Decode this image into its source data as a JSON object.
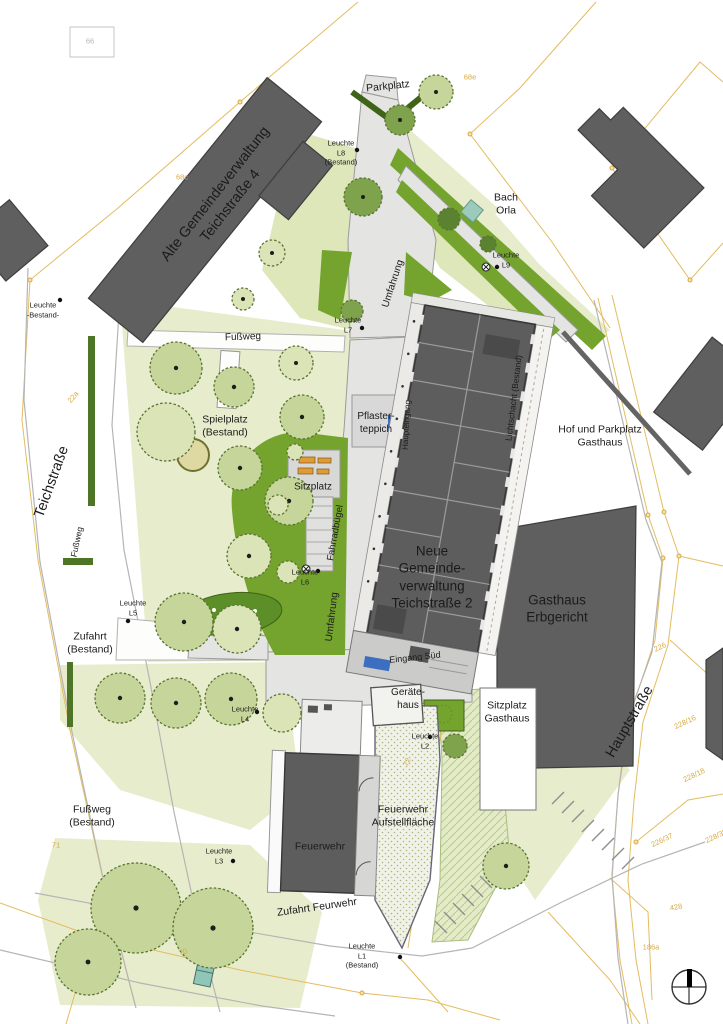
{
  "colors": {
    "label_black": "#1b1b1b",
    "parcel_orange": "#d8a940",
    "parcel_line": "#e3bc5f",
    "building_gray": "#5f5f5f",
    "road_gray": "#e4e4e2",
    "green_bright": "#74a42e",
    "green_pale": "#e7edcc",
    "hedge_dark": "#4e7426",
    "water_teal": "#93c7b7",
    "marker_blue": "#3c6fc1",
    "bench_orange": "#e39a35"
  },
  "compass": {
    "name": "north-arrow"
  },
  "map_labels": [
    {
      "name": "label-parkplatz",
      "text": "Parkplatz",
      "x": 388,
      "y": 87,
      "rot": -6,
      "size": 10.5
    },
    {
      "name": "label-leuchte-l8",
      "text": "Leuchte\nL8\n(Bestand)",
      "x": 341,
      "y": 153,
      "rot": 0,
      "size": 7.5
    },
    {
      "name": "label-alte-gemeindeverwaltung",
      "text": "Alte Gemeindeverwaltung\nTeichstraße 4",
      "x": 223,
      "y": 200,
      "rot": -52,
      "size": 14.5
    },
    {
      "name": "label-bach-orla",
      "text": "Bach\nOrla",
      "x": 506,
      "y": 205,
      "rot": 0,
      "size": 10.5
    },
    {
      "name": "label-leuchte-l9",
      "text": "Leuchte\nL9",
      "x": 506,
      "y": 260,
      "rot": 0,
      "size": 7.5
    },
    {
      "name": "label-leuchte-bestand",
      "text": "Leuchte\n-Bestand-",
      "x": 43,
      "y": 310,
      "rot": 0,
      "size": 7.5
    },
    {
      "name": "label-fussweg-nord",
      "text": "Fußweg",
      "x": 243,
      "y": 338,
      "rot": -2,
      "size": 10
    },
    {
      "name": "label-leuchte-l7",
      "text": "Leuchte\nL7",
      "x": 348,
      "y": 325,
      "rot": 0,
      "size": 7.5
    },
    {
      "name": "label-umfahrung-nord",
      "text": "Umfahrung",
      "x": 394,
      "y": 284,
      "rot": -72,
      "size": 10
    },
    {
      "name": "label-haupteingang",
      "text": "Haupteingang",
      "x": 407,
      "y": 425,
      "rot": -87,
      "size": 8
    },
    {
      "name": "label-lichtschacht",
      "text": "Lichtschacht (Bestand)",
      "x": 514,
      "y": 398,
      "rot": -83,
      "size": 8.5
    },
    {
      "name": "label-hof-parkplatz-gasthaus",
      "text": "Hof und Parkplatz\nGasthaus",
      "x": 600,
      "y": 437,
      "rot": 0,
      "size": 10.5
    },
    {
      "name": "label-spielplatz",
      "text": "Spielplatz\n(Bestand)",
      "x": 225,
      "y": 427,
      "rot": 0,
      "size": 10.5
    },
    {
      "name": "label-teichstrasse",
      "text": "Teichstraße",
      "x": 52,
      "y": 482,
      "rot": -70,
      "size": 14.5
    },
    {
      "name": "label-pflasterteppich",
      "text": "Pflaster-\nteppich",
      "x": 376,
      "y": 424,
      "rot": 0,
      "size": 10
    },
    {
      "name": "label-sitzplatz",
      "text": "Sitzplatz",
      "x": 313,
      "y": 488,
      "rot": 0,
      "size": 10
    },
    {
      "name": "label-fahrradbuegel",
      "text": "Fahrradbügel",
      "x": 336,
      "y": 533,
      "rot": -80,
      "size": 9.5
    },
    {
      "name": "label-leuchte-l6",
      "text": "Leuchte\nL6",
      "x": 305,
      "y": 577,
      "rot": 0,
      "size": 7.5
    },
    {
      "name": "label-fussweg-west",
      "text": "Fußweg",
      "x": 77,
      "y": 542,
      "rot": -78,
      "size": 8.5
    },
    {
      "name": "label-neue-gemeindeverwaltung",
      "text": "Neue\nGemeinde-\nverwaltung\nTeichstraße 2",
      "x": 432,
      "y": 577,
      "rot": 0,
      "size": 13.5
    },
    {
      "name": "label-gasthaus-erbgericht",
      "text": "Gasthaus\nErbgericht",
      "x": 557,
      "y": 609,
      "rot": 0,
      "size": 13.5
    },
    {
      "name": "label-eingang-sued",
      "text": "Eingang Süd",
      "x": 415,
      "y": 658,
      "rot": -6,
      "size": 9
    },
    {
      "name": "label-leuchte-l5",
      "text": "Leuchte\nL5",
      "x": 133,
      "y": 608,
      "rot": 0,
      "size": 7.5
    },
    {
      "name": "label-zufahrt-bestand",
      "text": "Zufahrt\n(Bestand)",
      "x": 90,
      "y": 644,
      "rot": 0,
      "size": 10.5
    },
    {
      "name": "label-umfahrung-sued",
      "text": "Umfahrung",
      "x": 333,
      "y": 617,
      "rot": -83,
      "size": 10
    },
    {
      "name": "label-hauptstrasse",
      "text": "Hauptstraße",
      "x": 630,
      "y": 722,
      "rot": -60,
      "size": 14.5
    },
    {
      "name": "label-geraetehaus",
      "text": "Geräte-\nhaus",
      "x": 408,
      "y": 700,
      "rot": 0,
      "size": 10
    },
    {
      "name": "label-sitzplatz-gasthaus",
      "text": "Sitzplatz\nGasthaus",
      "x": 507,
      "y": 713,
      "rot": 0,
      "size": 10.5
    },
    {
      "name": "label-leuchte-l2",
      "text": "Leuchte\nL2",
      "x": 425,
      "y": 741,
      "rot": 0,
      "size": 7.5
    },
    {
      "name": "label-leuchte-l4",
      "text": "Leuchte\nL4",
      "x": 245,
      "y": 714,
      "rot": 0,
      "size": 7.5
    },
    {
      "name": "label-fussweg-bestand",
      "text": "Fußweg\n(Bestand)",
      "x": 92,
      "y": 817,
      "rot": 0,
      "size": 10.5
    },
    {
      "name": "label-leuchte-l3",
      "text": "Leuchte\nL3",
      "x": 219,
      "y": 856,
      "rot": 0,
      "size": 7.5
    },
    {
      "name": "label-feuerwehr",
      "text": "Feuerwehr",
      "x": 320,
      "y": 847,
      "rot": 0,
      "size": 10.5
    },
    {
      "name": "label-aufstellflaeche",
      "text": "Feuerwehr\nAufstellfläche",
      "x": 403,
      "y": 817,
      "rot": 0,
      "size": 10.5
    },
    {
      "name": "label-zufahrt-feuerwehr",
      "text": "Zufahrt Feurwehr",
      "x": 317,
      "y": 908,
      "rot": -8,
      "size": 10.5
    },
    {
      "name": "label-leuchte-l1",
      "text": "Leuchte\nL1\n(Bestand)",
      "x": 362,
      "y": 956,
      "rot": 0,
      "size": 7.5
    }
  ],
  "parcel_labels": [
    {
      "name": "parcel-68e",
      "text": "68e",
      "x": 470,
      "y": 77,
      "rot": 0
    },
    {
      "name": "parcel-68c",
      "text": "68c",
      "x": 182,
      "y": 177,
      "rot": 0
    },
    {
      "name": "parcel-22a",
      "text": "22a",
      "x": 73,
      "y": 397,
      "rot": -50
    },
    {
      "name": "parcel-71",
      "text": "71",
      "x": 56,
      "y": 845,
      "rot": 0
    },
    {
      "name": "parcel-226",
      "text": "226",
      "x": 660,
      "y": 647,
      "rot": -25
    },
    {
      "name": "parcel-228-16",
      "text": "228/16",
      "x": 685,
      "y": 722,
      "rot": -25
    },
    {
      "name": "parcel-228-18",
      "text": "228/18",
      "x": 694,
      "y": 775,
      "rot": -25
    },
    {
      "name": "parcel-226-37",
      "text": "226/37",
      "x": 662,
      "y": 840,
      "rot": -25
    },
    {
      "name": "parcel-228-35",
      "text": "228/35",
      "x": 716,
      "y": 836,
      "rot": -25
    },
    {
      "name": "parcel-428",
      "text": "428",
      "x": 676,
      "y": 907,
      "rot": -10
    },
    {
      "name": "parcel-186a",
      "text": "186a",
      "x": 651,
      "y": 947,
      "rot": 0
    },
    {
      "name": "parcel-70",
      "text": "70",
      "x": 183,
      "y": 952,
      "rot": -20
    },
    {
      "name": "parcel-72",
      "text": "72",
      "x": 407,
      "y": 762,
      "rot": -65
    },
    {
      "name": "parcel-66",
      "text": "66",
      "x": 90,
      "y": 41,
      "rot": 0,
      "color": "#b5b5b5"
    }
  ]
}
